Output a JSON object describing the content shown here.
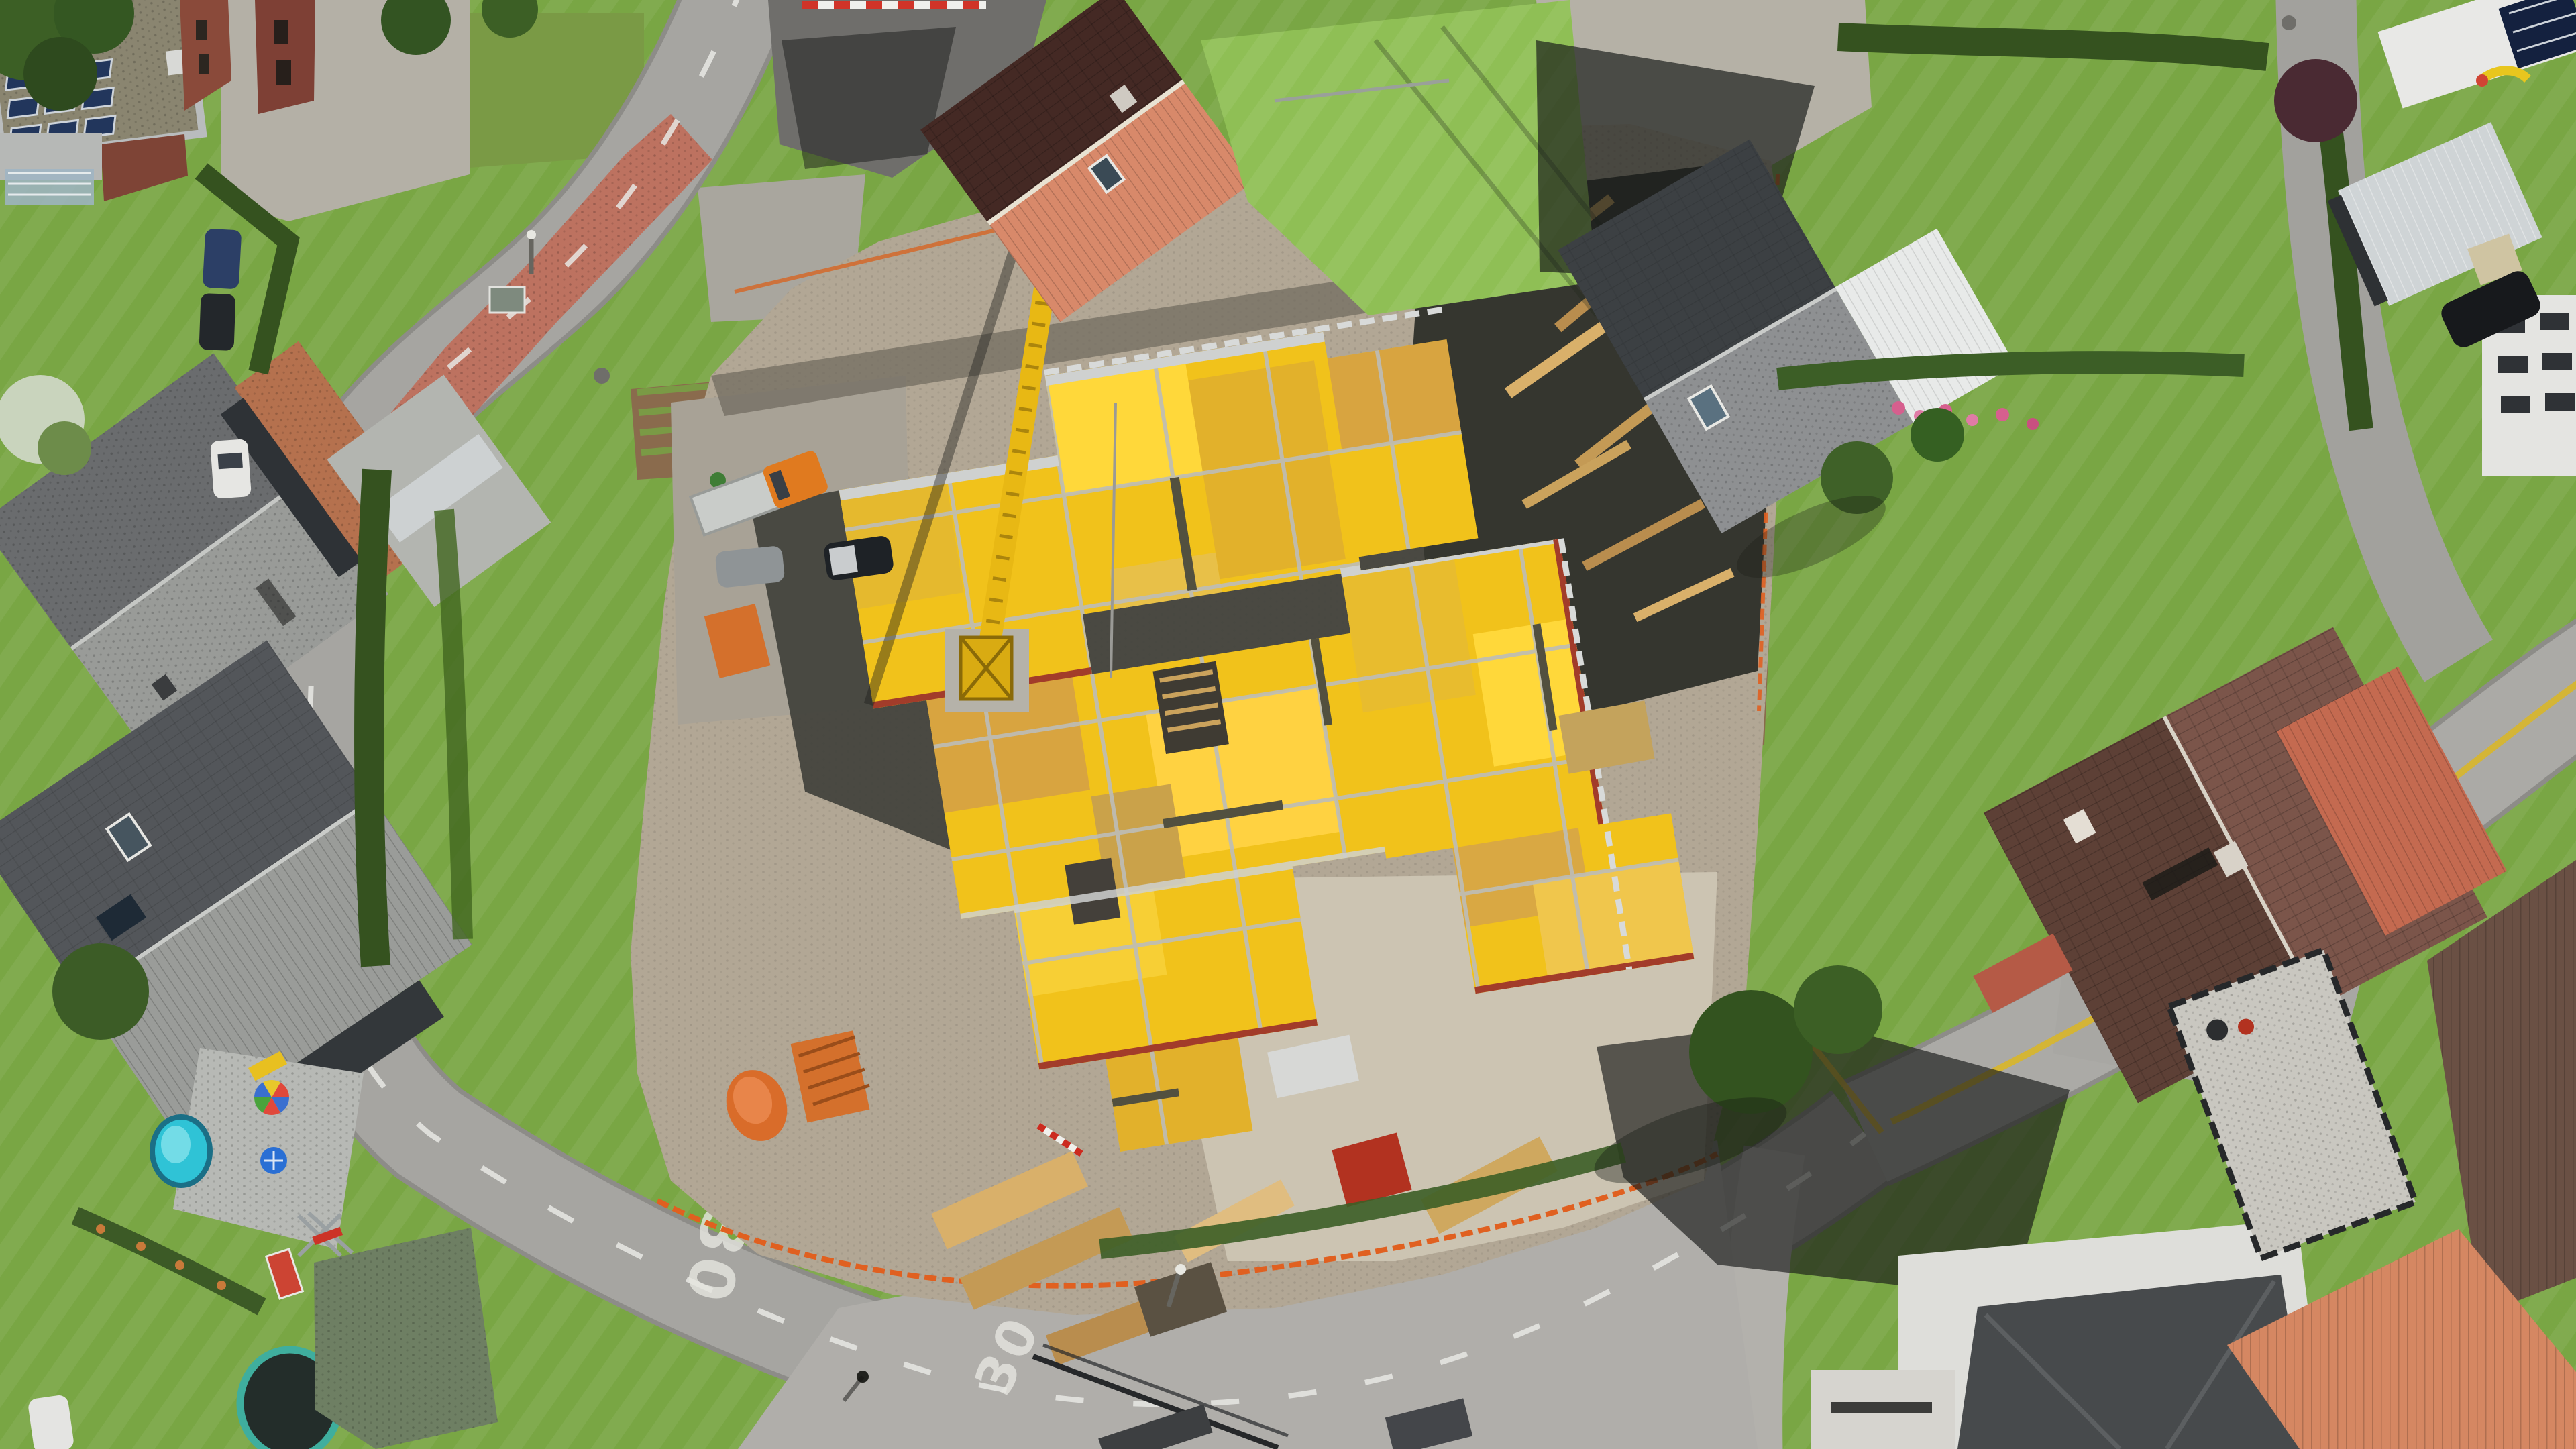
{
  "meta": {
    "type": "aerial-drone-photograph",
    "subject": "Top-down drone photo of a residential neighbourhood with a large construction site in the centre: a building slab covered in yellow formwork panels, a yellow tower crane, material laydown areas, surrounded by family houses, gardens and curving streets",
    "dimensions": "3840x2160"
  },
  "road_markings": {
    "speed_limit_west_bend": "30",
    "speed_limit_south_road": "30"
  },
  "palette": {
    "asphalt": "#a6a5a1",
    "asphalt_shade": "#8d8c88",
    "concrete_apron": "#b3b1ac",
    "dirt": "#b2a795",
    "dirt_dark": "#918879",
    "deep_shadow": "#2e2f2c",
    "grass": "#79a644",
    "grass_light": "#8fbf55",
    "hedge": "#35521f",
    "tree": "#3c5f25",
    "formwork_yellow": "#f1c21b",
    "formwork_yellow_bright": "#ffd83a",
    "formwork_wood": "#d8a440",
    "aluminium": "#cbcdcc",
    "crane_yellow": "#e8b814",
    "safety_orange": "#e06020",
    "machine_orange": "#e07a1f",
    "sidewalk_red": "#bd7260",
    "roof_dark_gray": "#45484a",
    "roof_gray": "#8e9092",
    "roof_brown": "#5d4036",
    "roof_brown_light": "#7b554a",
    "roof_salmon": "#d8896a",
    "roof_maroon": "#5f3a33",
    "solar_blue": "#1d2f52",
    "pool_turquoise": "#2fc3d6",
    "white_building": "#e7e7e4",
    "lane_yellow": "#d8b62a",
    "lane_white": "#e8e8e4"
  },
  "scene": {
    "construction_site": {
      "label": "construction site with yellow slab formwork deck",
      "barrier": "orange safety fencing"
    },
    "crane": {
      "label": "yellow tower crane with lattice jib"
    },
    "materials": [
      "timber stacks",
      "orange formwork pallets",
      "orange water tank",
      "red shoring props",
      "aluminium beams"
    ],
    "buildings": [
      {
        "label": "flat-roof building with rooftop solar panels (top left)"
      },
      {
        "label": "gable-roof house, maroon and salmon tiles (top centre)"
      },
      {
        "label": "gray gable-roof house with white conservatory (top right)"
      },
      {
        "label": "large brown-tile roof house with red carport (right)"
      },
      {
        "label": "white building with dark hip roof (bottom right)"
      },
      {
        "label": "two gray gable-roof houses (left)"
      }
    ],
    "garden_features": [
      "round turquoise pool",
      "rainbow parasol",
      "trampoline",
      "swing set",
      "kids slide",
      "vegetable beds",
      "hedges",
      "trees"
    ],
    "vehicles": [
      "orange flatbed truck",
      "grey car",
      "black car",
      "dark blue car",
      "white car",
      "black car on north-east street"
    ]
  }
}
